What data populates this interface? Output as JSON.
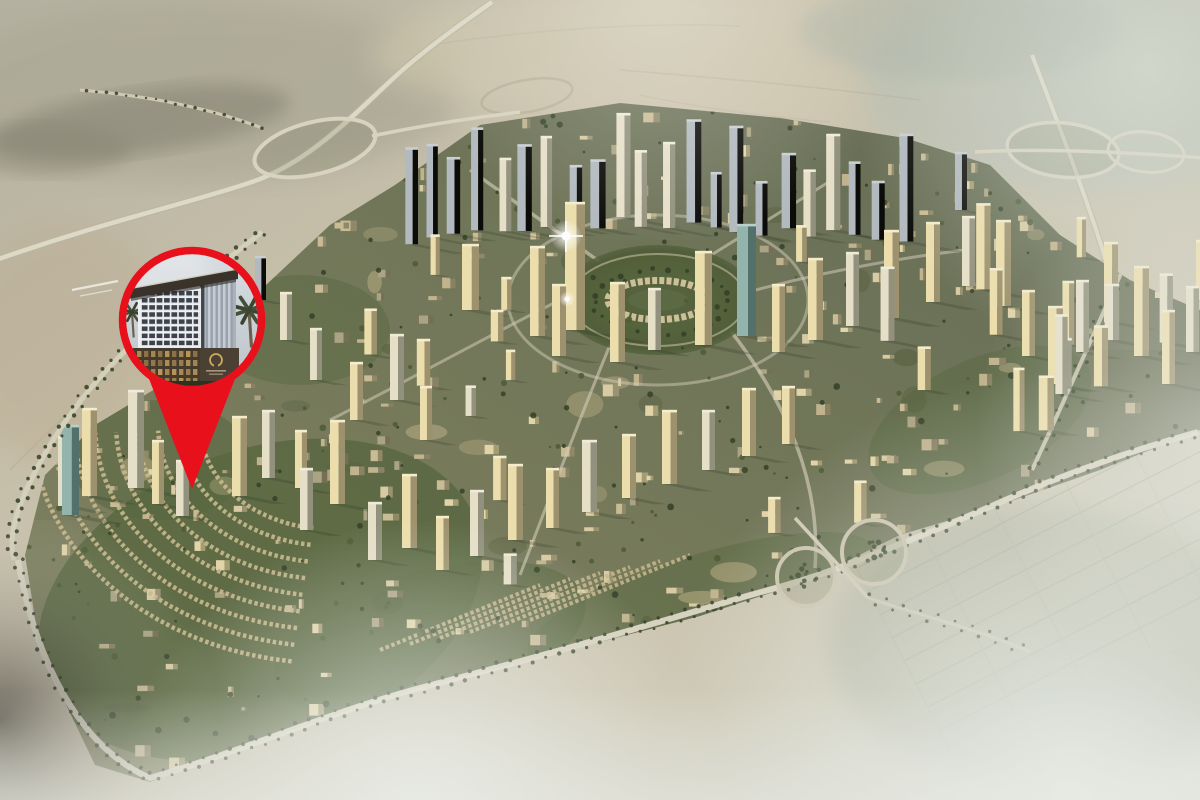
{
  "scene": {
    "kind": "aerial-masterplan-render",
    "setting": "circular desert master-planned community surrounded by sand and haze",
    "overlay": "red location pin with circular photo inset of a hotel tower",
    "visible_text": "none"
  },
  "marker": {
    "name": "location-pin",
    "style": "map-pin-with-circular-photo-inset",
    "inset_subject": "hotel-tower-rendering-with-palm-trees",
    "inset_logo": "gold-ring-emblem-illegible-caption",
    "tip_px": {
      "x": 192,
      "y": 489
    },
    "circle_center_px": {
      "x": 192,
      "y": 320
    },
    "circle_outer_radius_px": 73,
    "ring_width_px": 7
  },
  "features": [
    "central-circular-park",
    "highrise-tower-clusters",
    "lowrise-villa-arc-streets",
    "tree-lined-perimeter-boulevard",
    "cloverleaf-interchange-northwest",
    "highway-interchange-northeast",
    "loop-interchange-south",
    "desert-terrain",
    "morning-haze-fog",
    "sun-glint-on-tower"
  ],
  "colors": {
    "pin": "#e8101b",
    "desert_base": "#c6bda6",
    "desert_dark": "#878573",
    "desert_light": "#d2cab4",
    "city_ground": "#6f7355",
    "building_gold": "#eedfab",
    "building_cream": "#e7e0c9",
    "building_blue": "#b0b8bf",
    "building_teal": "#8fb3ac",
    "park_green": "#4e5c36",
    "greenery": "#53633b",
    "tree_green": "#2c3a20",
    "road_light": "#dcd8c6",
    "villa_row": "#c8b78c",
    "haze": "#edf0ec",
    "inset_sky": "#ccd4da",
    "inset_facade": "#dfe0e3",
    "inset_window": "#3c434c",
    "inset_canopy": "#39332b",
    "inset_podium": "#453b2d",
    "emblem_gold": "#cfa75f",
    "palm_green": "#45503a"
  }
}
